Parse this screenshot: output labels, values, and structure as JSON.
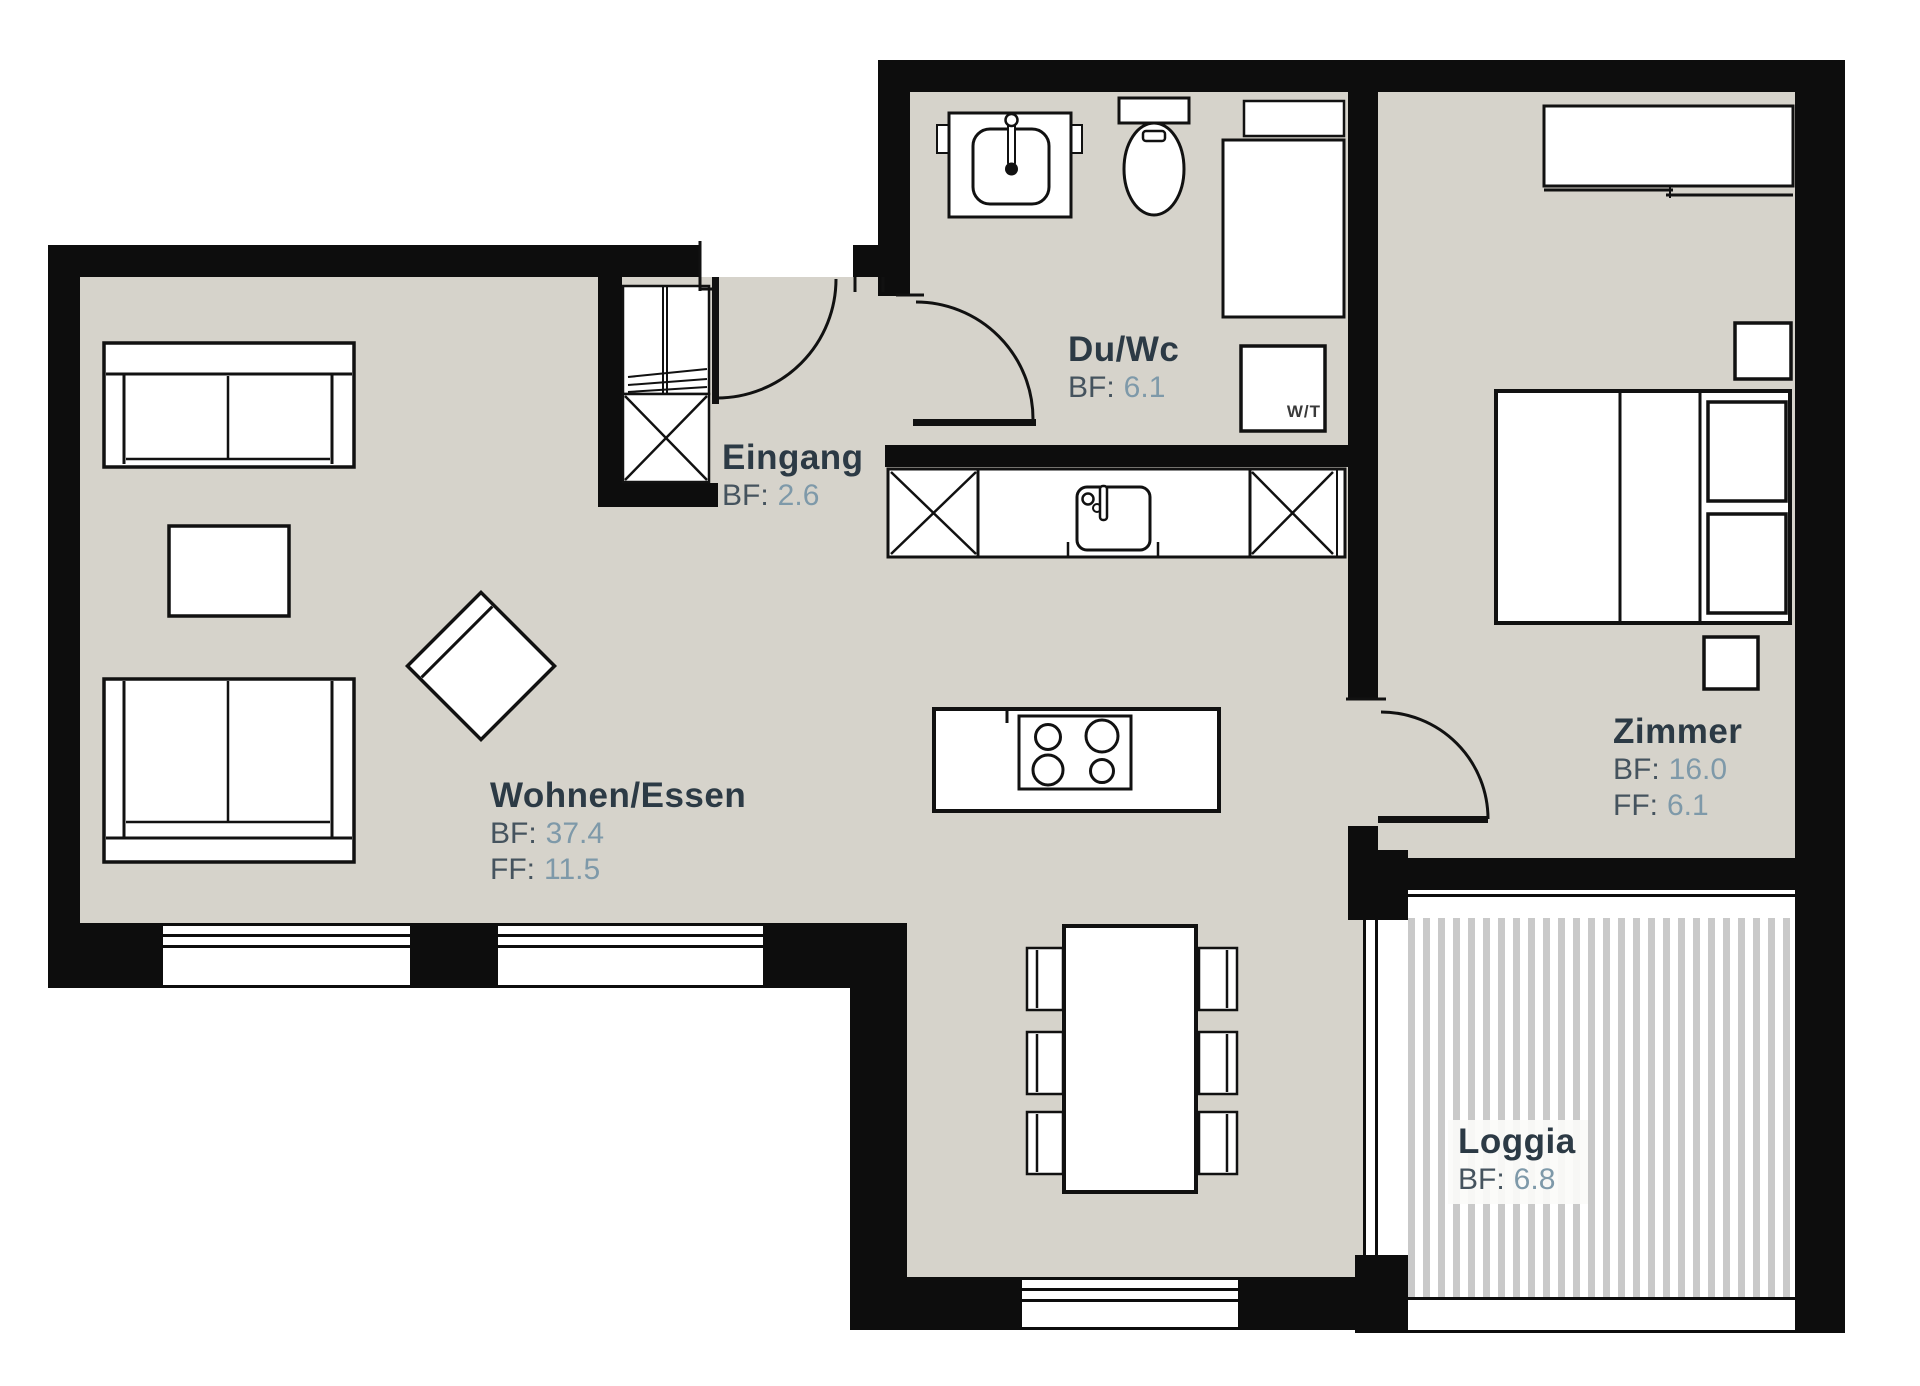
{
  "plan_title": "Apartment floor plan",
  "rooms": {
    "eingang": {
      "name": "Eingang",
      "bf_label": "BF:",
      "bf_value": "2.6"
    },
    "du_wc": {
      "name": "Du/Wc",
      "bf_label": "BF:",
      "bf_value": "6.1"
    },
    "wohnen_essen": {
      "name": "Wohnen/Essen",
      "bf_label": "BF:",
      "bf_value": "37.4",
      "ff_label": "FF:",
      "ff_value": "11.5"
    },
    "zimmer": {
      "name": "Zimmer",
      "bf_label": "BF:",
      "bf_value": "16.0",
      "ff_label": "FF:",
      "ff_value": "6.1"
    },
    "loggia": {
      "name": "Loggia",
      "bf_label": "BF:",
      "bf_value": "6.8"
    }
  },
  "fixtures": {
    "washer_dryer_label": "W/T"
  },
  "colors": {
    "background": "#ffffff",
    "floor": "#d6d3cb",
    "wall": "#0d0d0d",
    "furniture_outline": "#111111",
    "room_name_text": "#2c3a45",
    "value_label_text": "#45535e",
    "value_number_text": "#7e99a9",
    "loggia_stripe": "#c9c9c9"
  }
}
